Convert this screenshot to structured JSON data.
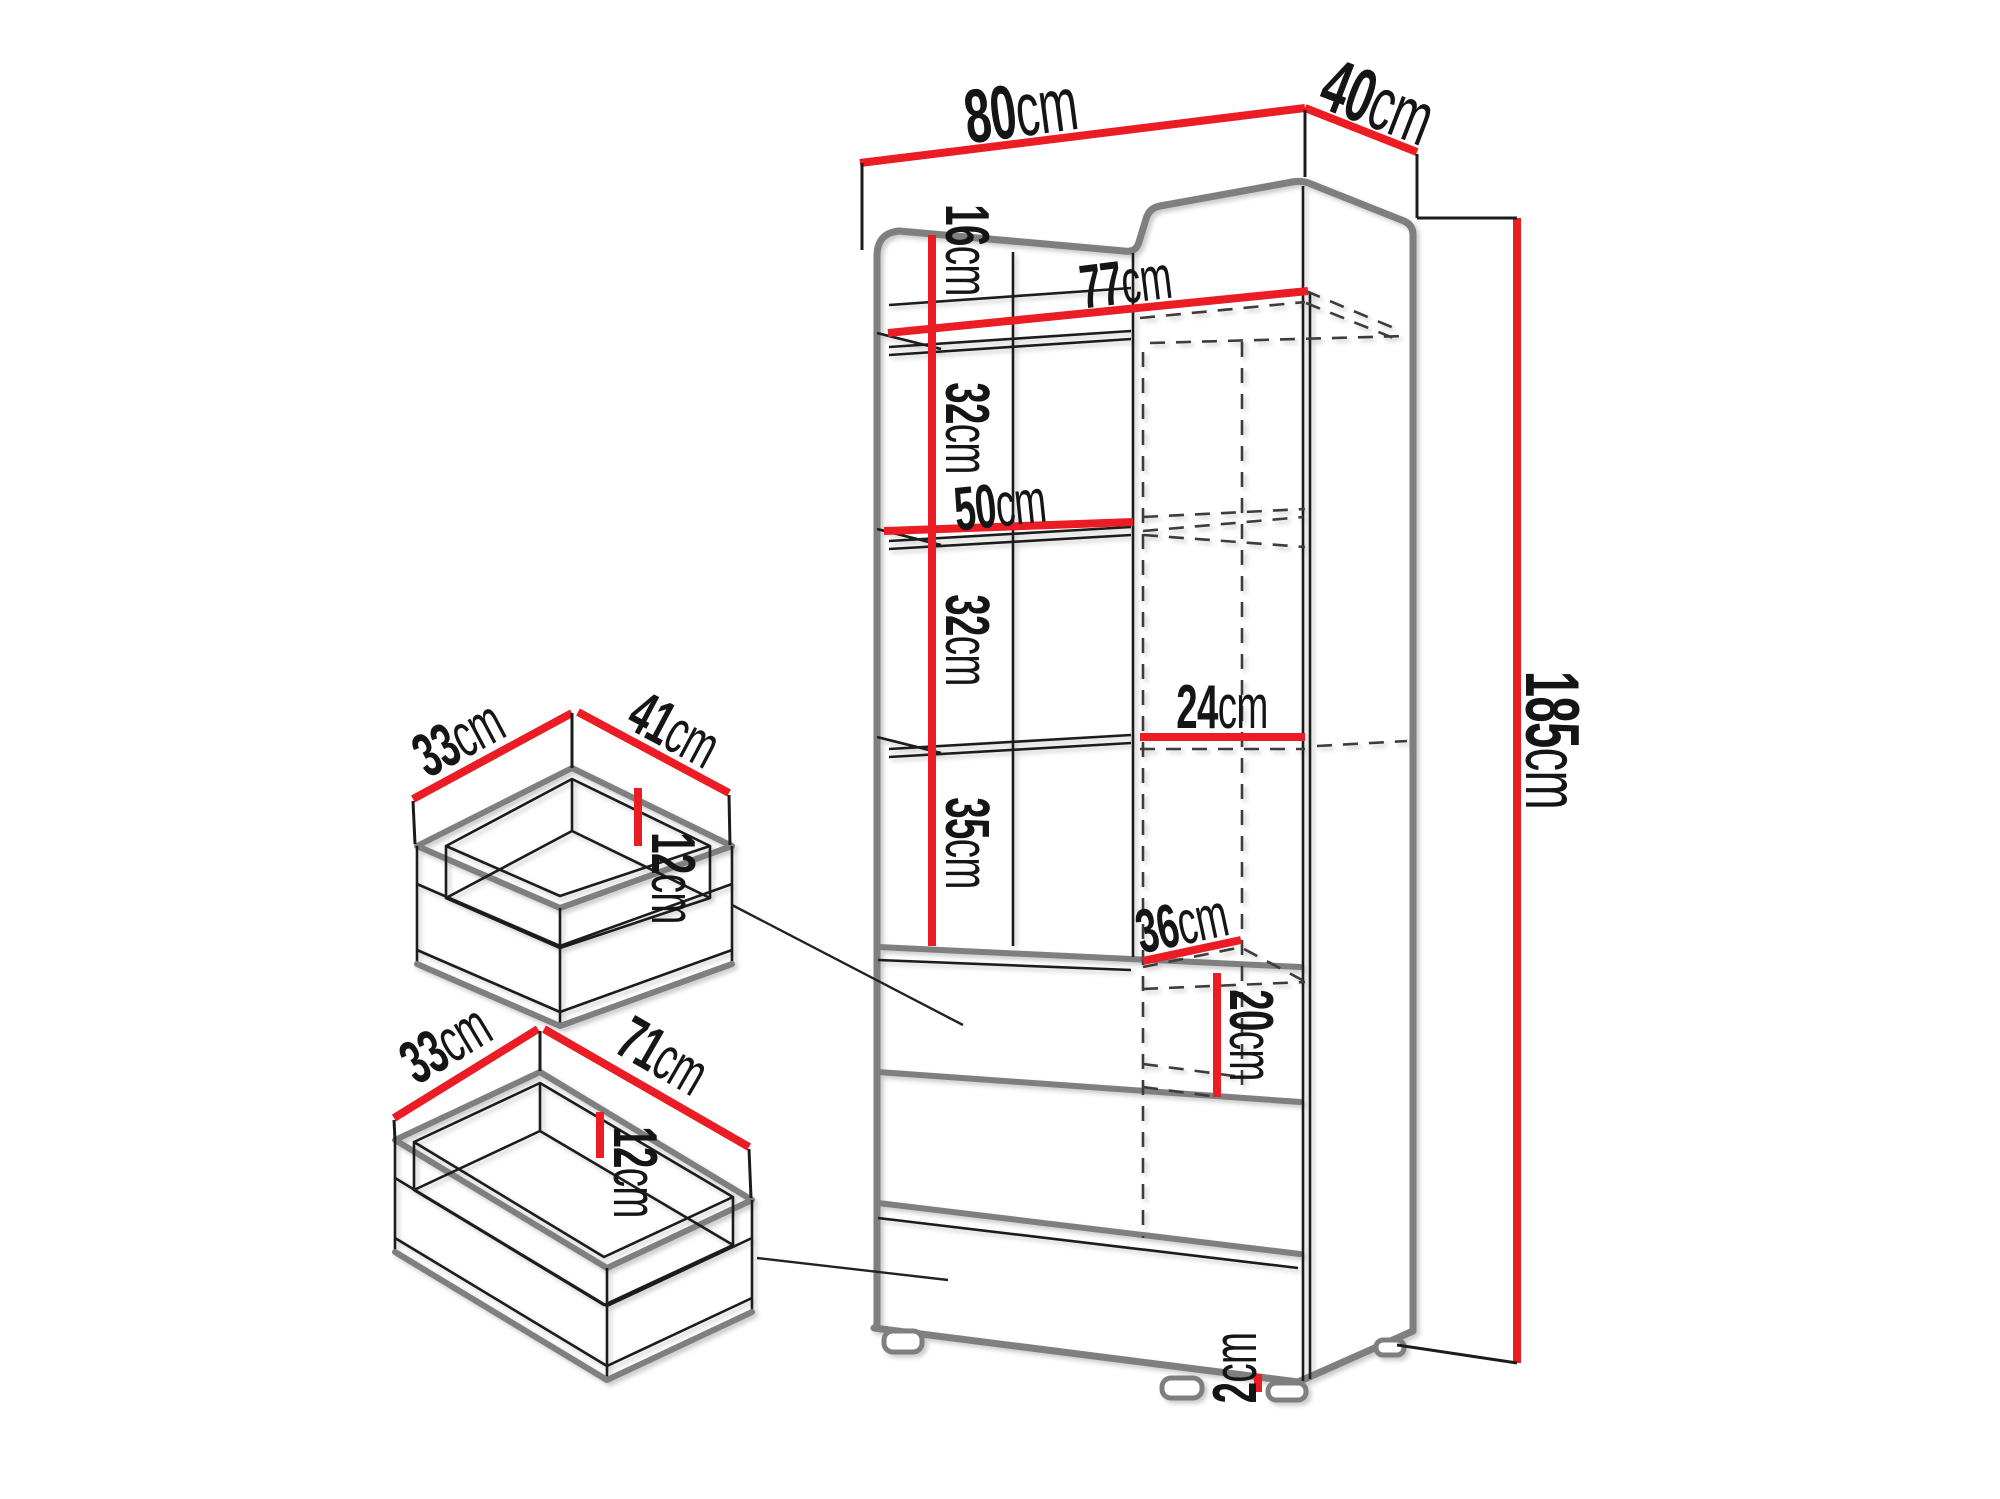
{
  "colors": {
    "dimension_red": "#ec1c24",
    "outline_gray": "#7f7f7f",
    "line_black": "#1c1c1c"
  },
  "cabinet": {
    "labels": {
      "w80": {
        "num": "80",
        "unit": "cm"
      },
      "d40": {
        "num": "40",
        "unit": "cm"
      },
      "h16": {
        "num": "16",
        "unit": "cm"
      },
      "w77": {
        "num": "77",
        "unit": "cm"
      },
      "g32a": {
        "num": "32",
        "unit": "cm"
      },
      "w50": {
        "num": "50",
        "unit": "cm"
      },
      "g32b": {
        "num": "32",
        "unit": "cm"
      },
      "w24": {
        "num": "24",
        "unit": "cm"
      },
      "g35": {
        "num": "35",
        "unit": "cm"
      },
      "w36": {
        "num": "36",
        "unit": "cm"
      },
      "h20": {
        "num": "20",
        "unit": "cm"
      },
      "h185": {
        "num": "185",
        "unit": "cm"
      },
      "h2": {
        "num": "2",
        "unit": "cm"
      }
    }
  },
  "small_drawer": {
    "labels": {
      "d33": {
        "num": "33",
        "unit": "cm"
      },
      "w41": {
        "num": "41",
        "unit": "cm"
      },
      "h12": {
        "num": "12",
        "unit": "cm"
      }
    }
  },
  "large_drawer": {
    "labels": {
      "d33": {
        "num": "33",
        "unit": "cm"
      },
      "w71": {
        "num": "71",
        "unit": "cm"
      },
      "h12": {
        "num": "12",
        "unit": "cm"
      }
    }
  }
}
